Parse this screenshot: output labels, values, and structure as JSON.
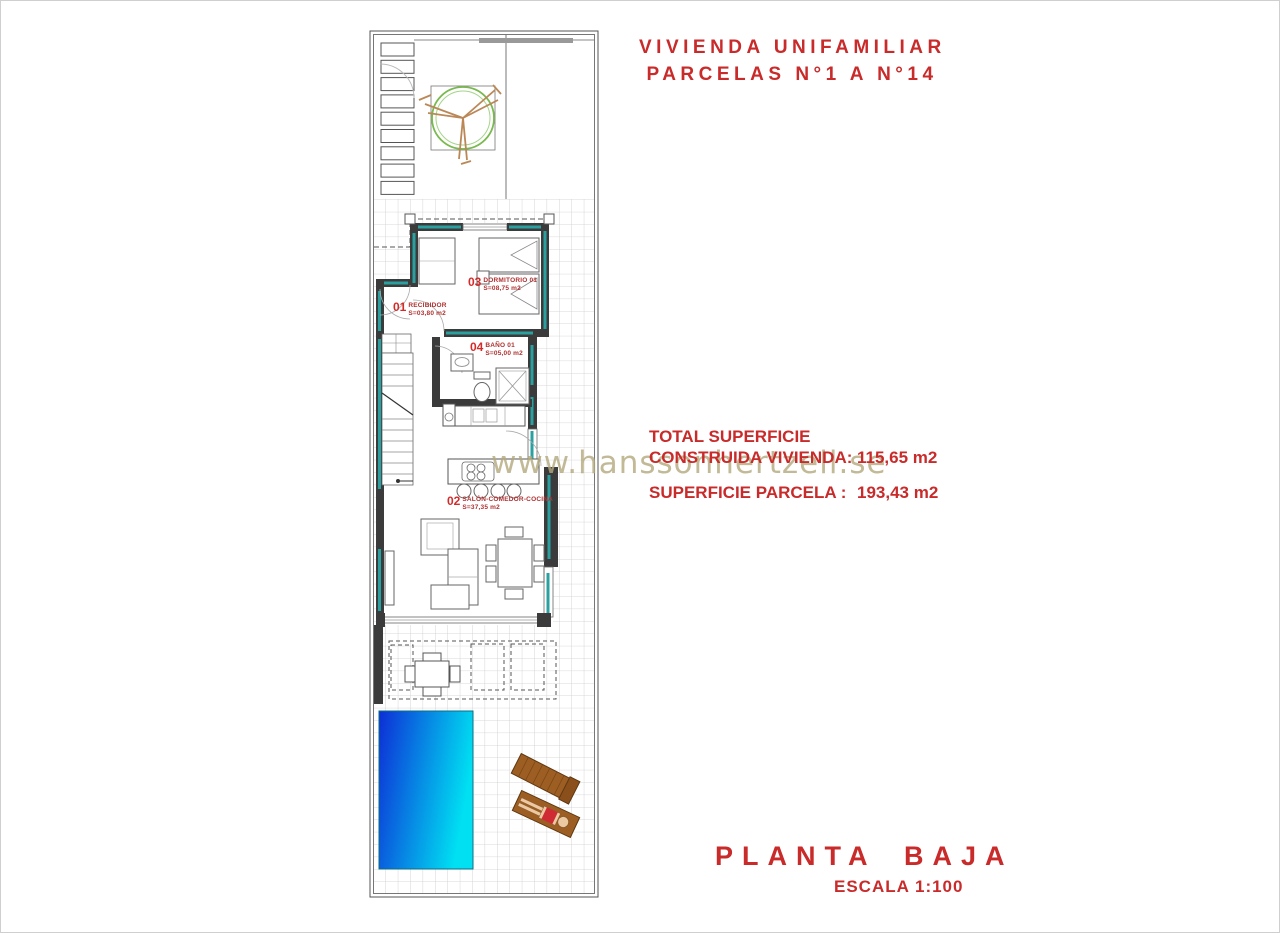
{
  "header": {
    "title_line1": "VIVIENDA UNIFAMILIAR",
    "title_line2": "PARCELAS N°1 A N°14"
  },
  "summary": {
    "total_line1": "TOTAL SUPERFICIE",
    "total_line2": "CONSTRUIDA VIVIENDA:",
    "built_value": "115,65 m2",
    "parcel_label": "SUPERFICIE PARCELA :",
    "parcel_value": "193,43 m2"
  },
  "footer": {
    "plan_name": "PLANTA BAJA",
    "scale": "ESCALA 1:100"
  },
  "watermark": {
    "text": "www.hanssonhertzell.se"
  },
  "rooms": [
    {
      "num": "01",
      "name": "RECIBIDOR",
      "area": "S=03,80 m2"
    },
    {
      "num": "02",
      "name": "SALÓN-COMEDOR-COCINA",
      "area": "S=37,35 m2"
    },
    {
      "num": "03",
      "name": "DORMITORIO 01",
      "area": "S=08,75 m2"
    },
    {
      "num": "04",
      "name": "BAÑO 01",
      "area": "S=05,00 m2"
    }
  ],
  "colors": {
    "accent_red": "#c92a2a",
    "wall_dark": "#3b3b3b",
    "insulation_teal": "#2aa0a0",
    "pool_deep": "#0d2ed6",
    "pool_light": "#00e0f2",
    "tree_green": "#79b94e",
    "lounger_brown": "#9c5e22",
    "watermark_tan": "#b3a87c",
    "tile_grid": "#cdcdcd"
  }
}
